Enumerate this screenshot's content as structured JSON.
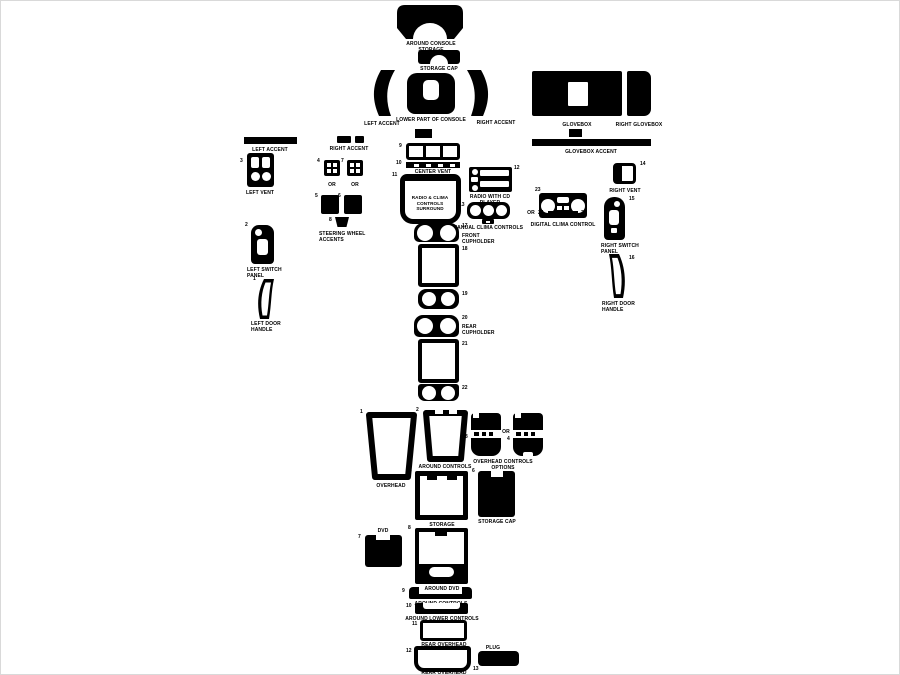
{
  "colors": {
    "ink": "#000000",
    "bg": "#ffffff",
    "frame": "#d9d9d9"
  },
  "or_label": "OR",
  "parts": {
    "around_console_storage": {
      "label": "AROUND CONSOLE STORAGE"
    },
    "storage_cap_top": {
      "label": "STORAGE CAP"
    },
    "left_accent_console": {
      "label": "LEFT ACCENT"
    },
    "lower_part_of_console": {
      "label": "LOWER PART OF CONSOLE"
    },
    "right_accent_console": {
      "label": "RIGHT ACCENT"
    },
    "glovebox": {
      "label": "GLOVEBOX"
    },
    "right_glovebox": {
      "label": "RIGHT GLOVEBOX"
    },
    "glovebox_accent": {
      "label": "GLOVEBOX ACCENT"
    },
    "left_accent": {
      "label": "LEFT ACCENT"
    },
    "left_vent": {
      "num": "3",
      "label": "LEFT VENT"
    },
    "left_switch_panel": {
      "num": "2",
      "label": "LEFT SWITCH PANEL"
    },
    "left_door_handle": {
      "num": "1",
      "label": "LEFT DOOR HANDLE"
    },
    "right_accent": {
      "label": "RIGHT ACCENT"
    },
    "sw_option_a": {
      "num": "4"
    },
    "sw_option_b": {
      "num": "7"
    },
    "sw_left": {
      "num": "5"
    },
    "sw_right": {
      "num": "6"
    },
    "sw_center": {
      "num": "8"
    },
    "steering_wheel_accents": {
      "label": "STEERING WHEEL ACCENTS"
    },
    "center_vent": {
      "num": "9",
      "label": "CENTER VENT"
    },
    "center_vent_trim": {
      "num": "10"
    },
    "radio_surround": {
      "num": "11",
      "label": "RADIO & CLIMA CONTROLS SURROUND"
    },
    "radio_cd": {
      "num": "12",
      "label": "RADIO WITH CD PLAYER"
    },
    "manual_clima": {
      "num": "13",
      "label": "MANUAL CLIMA CONTROLS"
    },
    "digital_clima": {
      "num": "23",
      "label": "DIGITAL CLIMA CONTROL",
      "num_left": "24",
      "num_right": "25"
    },
    "right_vent": {
      "num": "14",
      "label": "RIGHT VENT"
    },
    "right_switch_panel": {
      "num": "15",
      "label": "RIGHT SWITCH PANEL"
    },
    "right_door_handle": {
      "num": "16",
      "label": "RIGHT DOOR HANDLE"
    },
    "front_cupholder": {
      "num": "17",
      "label": "FRONT CUPHOLDER"
    },
    "front_console_frame": {
      "num": "18"
    },
    "mid_cupholder": {
      "num": "19"
    },
    "rear_cupholder": {
      "num": "20",
      "label": "REAR CUPHOLDER"
    },
    "rear_console_frame": {
      "num": "21"
    },
    "rear_cup_insert": {
      "num": "22"
    },
    "overhead": {
      "num": "1",
      "label": "OVERHEAD"
    },
    "around_controls": {
      "num": "2",
      "label": "AROUND CONTROLS"
    },
    "overhead_option_a": {
      "num": "3"
    },
    "overhead_option_b": {
      "num": "4"
    },
    "overhead_controls_options": {
      "label": "OVERHEAD CONTROLS OPTIONS"
    },
    "storage": {
      "num": "5",
      "label": "STORAGE"
    },
    "storage_cap_lower": {
      "num": "6",
      "label": "STORAGE CAP"
    },
    "dvd": {
      "num": "7",
      "label": "DVD"
    },
    "around_dvd": {
      "num": "8",
      "label": "AROUND DVD"
    },
    "around_controls_lower": {
      "num": "9",
      "label": "AROUND CONTROLS"
    },
    "around_lower_controls": {
      "num": "10",
      "label": "AROUND LOWER CONTROLS"
    },
    "rear_overhead_small": {
      "num": "11",
      "label": "REAR OVERHEAD"
    },
    "rear_overhead_large": {
      "num": "12",
      "label": "REAR OVERHEAD"
    },
    "plug": {
      "num": "13",
      "label": "PLUG"
    }
  }
}
